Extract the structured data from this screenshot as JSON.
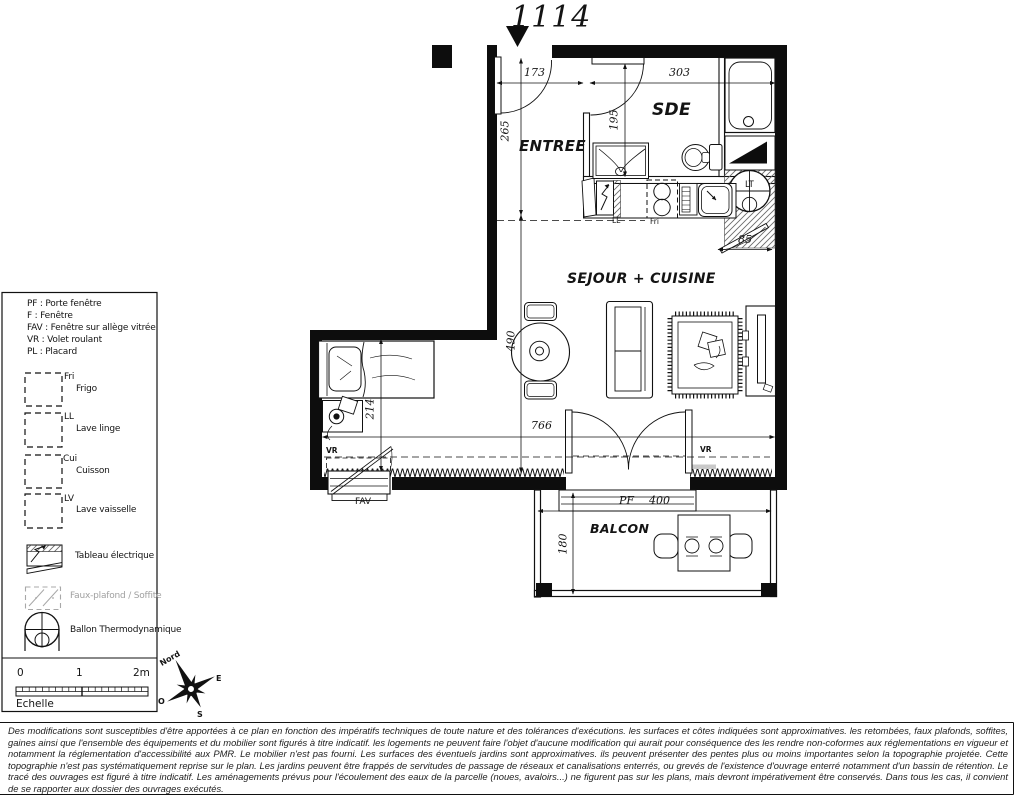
{
  "title": "1114",
  "plan": {
    "rooms": {
      "entree": "ENTREE",
      "sde": "SDE",
      "sejour": "SEJOUR + CUISINE",
      "balcon": "BALCON"
    },
    "dims": {
      "w_entree": "173",
      "w_sde": "303",
      "h_entree": "265",
      "h_sde": "195",
      "h_sejour": "490",
      "h_bed": "214",
      "w_sejour": "766",
      "w_tech_door": "85",
      "w_balcony": "400",
      "h_balcony": "180"
    },
    "labels": {
      "pf": "PF",
      "ll": "LL",
      "fri": "Fri",
      "fav": "FAV",
      "vr_left": "VR",
      "vr_right": "VR",
      "lt": "LT"
    }
  },
  "legend": {
    "abbreviations": [
      "PF : Porte fenêtre",
      "F : Fenêtre",
      "FAV : Fenêtre sur allège vitrée",
      "VR : Volet roulant",
      "PL : Placard"
    ],
    "appliances": [
      {
        "abbr": "Fri",
        "name": "Frigo"
      },
      {
        "abbr": "LL",
        "name": "Lave linge"
      },
      {
        "abbr": "Cui",
        "name": "Cuisson"
      },
      {
        "abbr": "LV",
        "name": "Lave vaisselle"
      }
    ],
    "symbols": [
      {
        "name": "Tableau électrique"
      },
      {
        "name": "Faux-plafond / Soffite"
      },
      {
        "name": "Ballon Thermodynamique"
      }
    ]
  },
  "scalebar": {
    "tick0": "0",
    "tick1": "1",
    "tick2": "2m",
    "label": "Echelle"
  },
  "compass": {
    "north": "Nord",
    "east": "E",
    "west": "O",
    "south": "S"
  },
  "disclaimer": "Des modifications sont susceptibles d'être apportées à ce plan en fonction des impératifs techniques de toute nature et des tolérances d'exécutions. les surfaces et côtes indiquées sont approximatives. les retombées, faux plafonds, soffites, gaines ainsi que l'ensemble des équipements et du mobilier sont figurés à titre indicatif. les logements ne peuvent faire l'objet d'aucune modification qui aurait pour conséquence des les rendre non-coformes aux réglementations en vigueur et notamment la réglementation d'accessibilité aux PMR. Le mobilier n'est pas fourni. Les surfaces des éventuels jardins sont approximatives. ils peuvent présenter des pentes plus ou moins importantes selon la topographie projetée. Cette topographie n'est pas systématiquement reprise sur le plan. Les jardins peuvent être frappés de servitudes de passage de réseaux et canalisations enterrés, ou grevés de l'existence d'ouvrage enterré notamment d'un bassin de rétention. Le tracé des ouvrages est figuré à titre indicatif. Les aménagements prévus pour l'écoulement des eaux de la parcelle (noues, avaloirs...) ne figurent pas sur les plans, mais devront impérativement être conservés. Dans tous les cas, il convient de se rapporter aux dossier des ouvrages exécutés."
}
